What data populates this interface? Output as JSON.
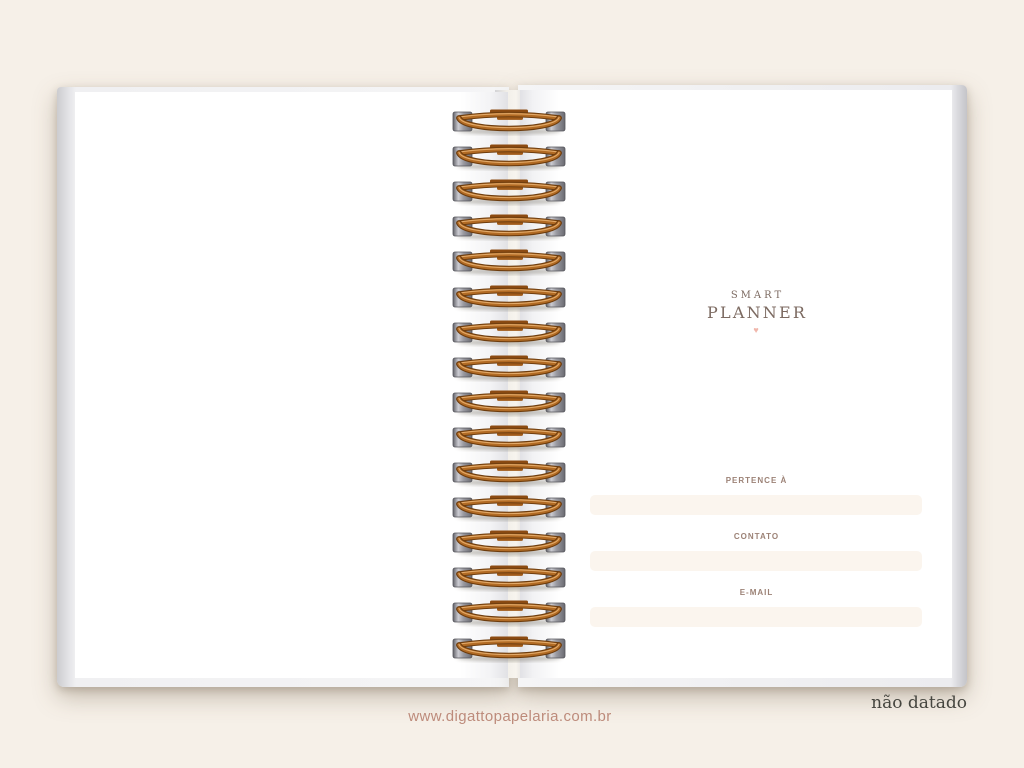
{
  "background_color": "#f6f0e8",
  "notebook": {
    "brand": {
      "line1": "SMART",
      "line2": "PLANNER",
      "heart_glyph": "♥",
      "text_color": "#7c6a61",
      "heart_color": "#f0b6ab"
    },
    "form": {
      "fields": [
        {
          "label": "PERTENCE À",
          "value": ""
        },
        {
          "label": "CONTATO",
          "value": ""
        },
        {
          "label": "E-MAIL",
          "value": ""
        }
      ],
      "label_color": "#9c8276",
      "field_bg_color": "#fbf5ee"
    },
    "binding": {
      "ring_count": 16,
      "wire_color": "#b26b24",
      "slot_color": "#9a9aa1"
    }
  },
  "footer": {
    "website": "www.digattopapelaria.com.br",
    "website_color": "#bd8b7b",
    "note": "não datado",
    "note_color": "#45453f"
  }
}
